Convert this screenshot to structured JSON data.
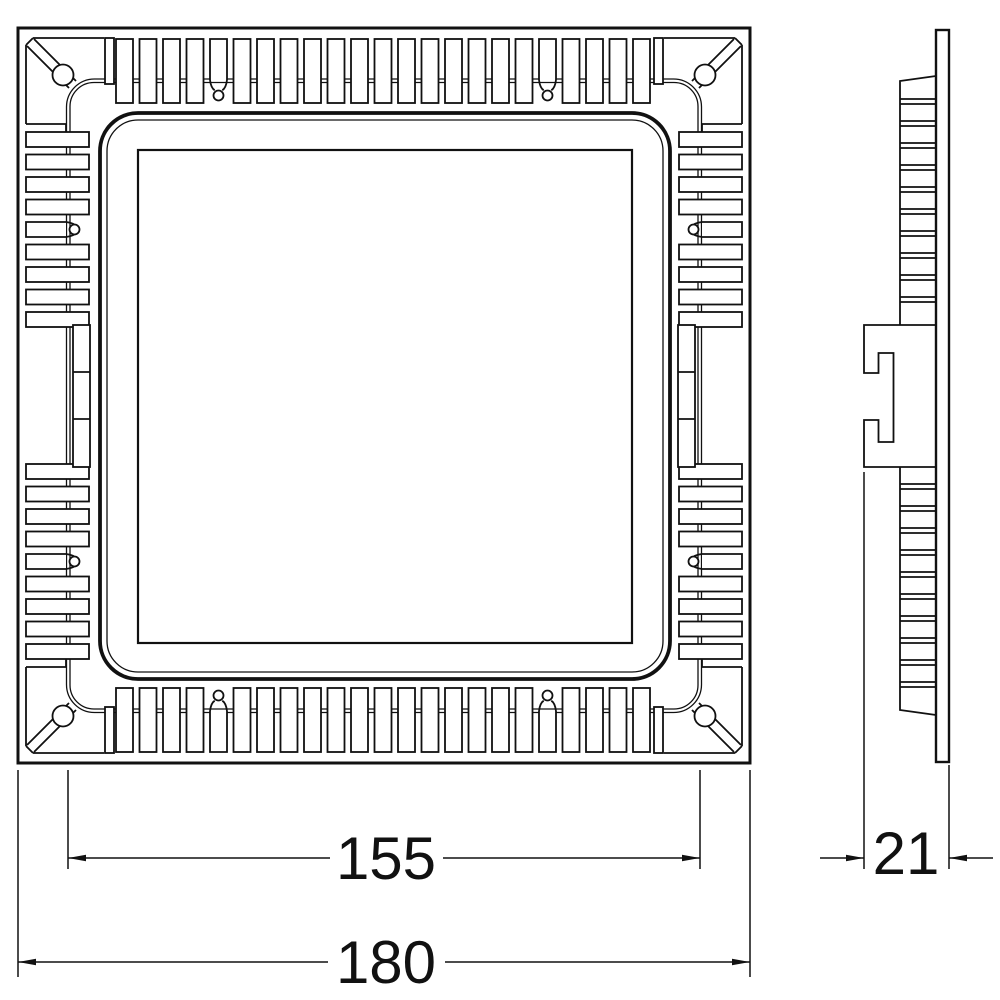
{
  "colors": {
    "line": "#111111",
    "background": "#ffffff"
  },
  "dimensions": {
    "cutout_size": {
      "value": "155"
    },
    "overall_size": {
      "value": "180"
    },
    "depth": {
      "value": "21"
    }
  }
}
